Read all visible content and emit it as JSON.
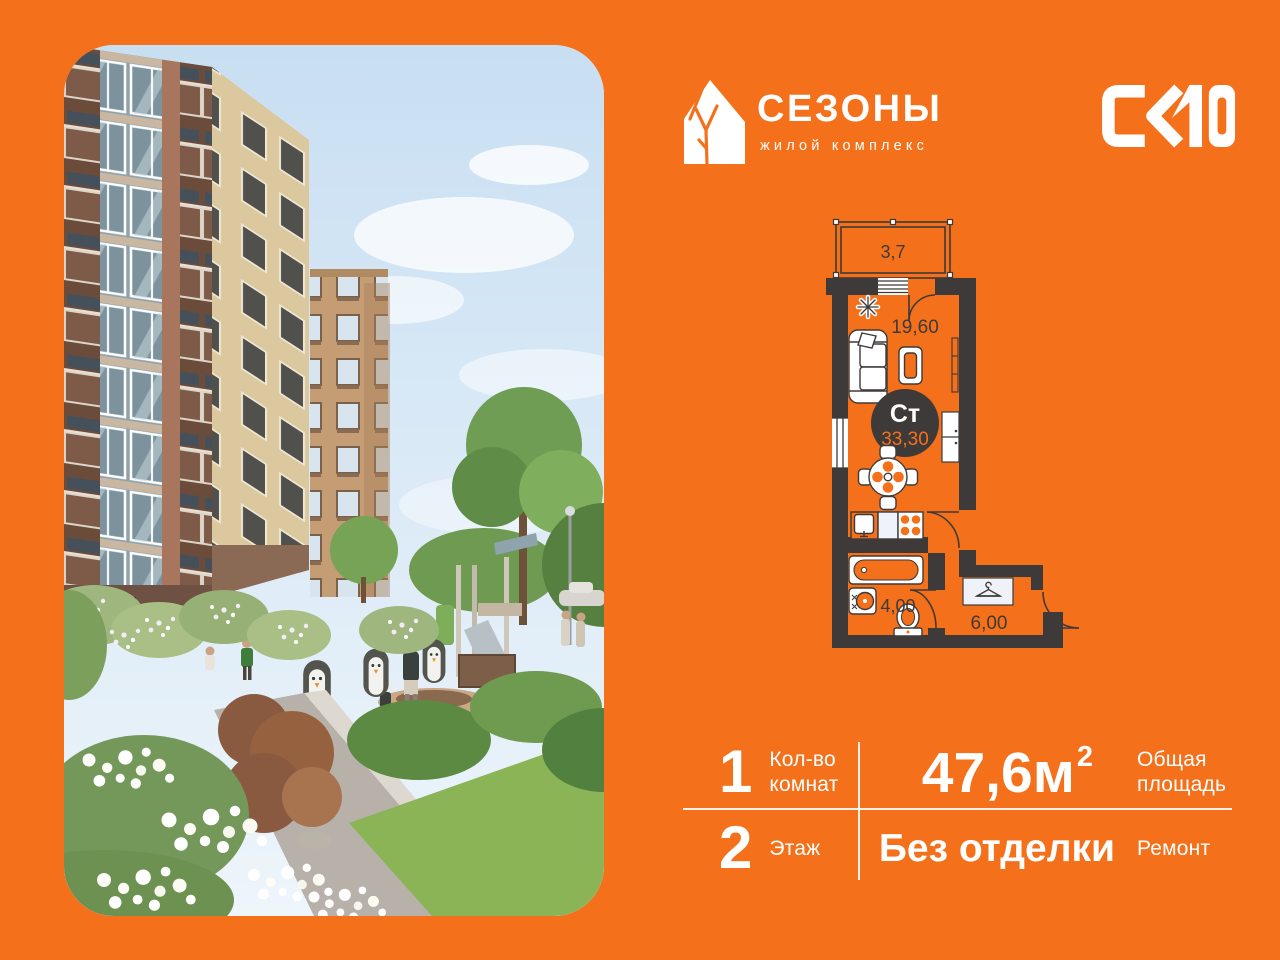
{
  "colors": {
    "background": "#F4701A",
    "plan_walls": "#3E3A39",
    "plan_text": "#3E3A39",
    "text_on_orange": "#FFFFFF",
    "photo_sky": "#D7E8F6"
  },
  "brand": {
    "name": "СЕЗОНЫ",
    "subtitle": "жилой комплекс",
    "developer": "СК10"
  },
  "icons": {
    "brand": "house-icon",
    "wardrobe": "hanger-icon",
    "plant": "plant-icon"
  },
  "plan": {
    "badge_type": "Ст",
    "badge_area": "33,30",
    "balcony_area": "3,7",
    "room_area": "19,60",
    "bath_area": "4,00",
    "hall_area": "6,00"
  },
  "specs": {
    "rooms": {
      "value": "1",
      "label": "Кол-во комнат"
    },
    "area": {
      "value": "47,6м",
      "sup": "2",
      "label": "Общая площадь"
    },
    "floor": {
      "value": "2",
      "label": "Этаж"
    },
    "finish": {
      "value": "Без отделки",
      "label": "Ремонт"
    }
  }
}
